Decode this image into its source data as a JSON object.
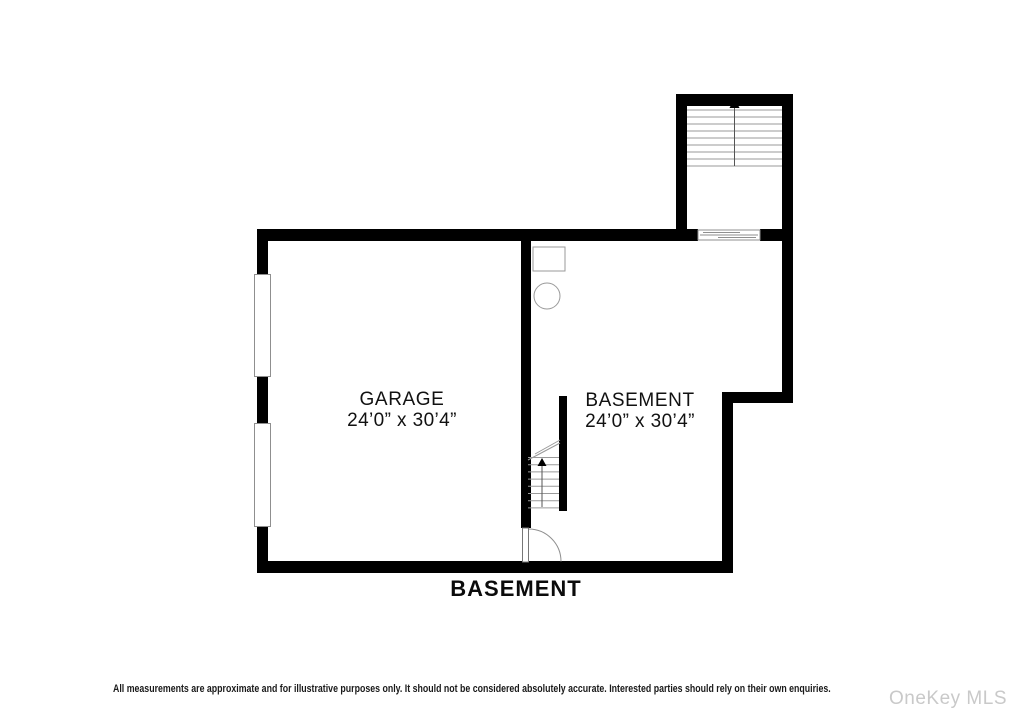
{
  "plan": {
    "bottom_title": "BASEMENT",
    "rooms": [
      {
        "name": "GARAGE",
        "dimensions": "24’0” x 30’4”"
      },
      {
        "name": "BASEMENT",
        "dimensions": "24’0” x 30’4”"
      }
    ],
    "fixtures": [
      "upper-staircase-with-up-arrow",
      "basement-staircase-with-up-arrow",
      "sliding-door",
      "swing-door",
      "garage-door-opening-upper",
      "garage-door-opening-lower",
      "utility-box",
      "utility-tank-circle"
    ]
  },
  "footer": {
    "disclaimer": "All measurements are approximate and for illustrative purposes only. It should not be considered absolutely accurate. Interested parties should rely on their own enquiries.",
    "watermark": "OneKey MLS"
  },
  "colors": {
    "wall": "#000000",
    "fixture_outline": "#8f8f8f",
    "stair_line": "#9a9a9a",
    "watermark": "#c9c9c9"
  }
}
